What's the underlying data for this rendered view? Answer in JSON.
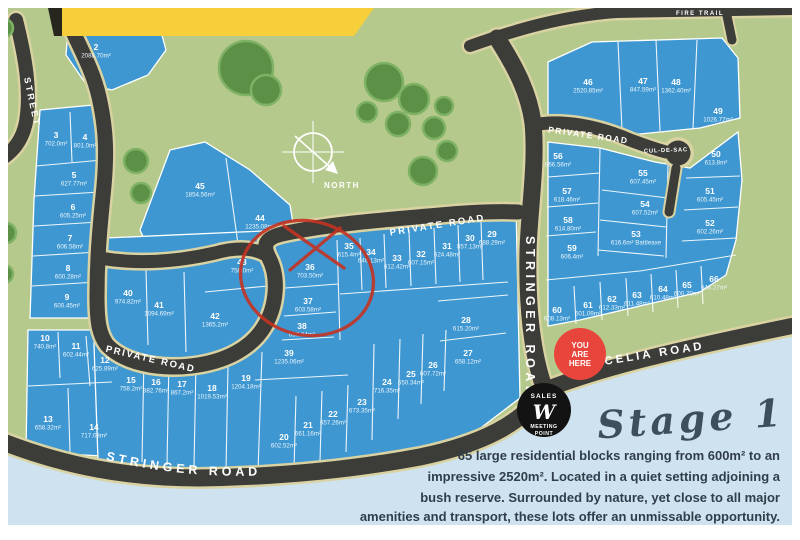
{
  "title": "Stage 1 estate map",
  "compass": {
    "label": "NORTH"
  },
  "roads": {
    "street_left": "STREET",
    "private_lower": "PRIVATE ROAD",
    "private_upper": "PRIVATE ROAD",
    "private_topright": "PRIVATE ROAD",
    "stringer_vertical": "STRINGER ROAD",
    "stringer_bottom": "STRINGER ROAD",
    "celia": "CELIA ROAD",
    "cul_de_sac": "CUL-DE-SAC",
    "fire_trail": "FIRE TRAIL"
  },
  "markers": {
    "you_are_here": {
      "lines": [
        "YOU",
        "ARE",
        "HERE"
      ],
      "color": "#e8463c"
    },
    "sales_point": {
      "top": "SALES",
      "logo": "W",
      "bottom1": "MEETING",
      "bottom2": "POINT",
      "color": "#131313"
    }
  },
  "stage": {
    "title": "Stage 1",
    "lines": [
      "65 large residential blocks ranging from 600m² to an",
      "impressive 2520m². Located in a quiet setting adjoining a",
      "bush reserve. Surrounded by nature, yet close to all major",
      "amenities and transport, these lots offer an unmissable opportunity."
    ]
  },
  "colors": {
    "green": "#b5c98c",
    "lot_blue": "#3e97d1",
    "pale_blue": "#cfe2ef",
    "road": "#3c3c38",
    "road_edge": "#d9d2a2",
    "tree": "#5d9047",
    "annotation_red": "#c53322",
    "banner_yellow": "#f6cf3b",
    "text_dark": "#2f3e4a"
  },
  "lots": [
    {
      "n": "2",
      "a": "2088.70m²",
      "x": 96,
      "y": 50
    },
    {
      "n": "3",
      "a": "702.0m²",
      "x": 56,
      "y": 138
    },
    {
      "n": "4",
      "a": "801.0m²",
      "x": 85,
      "y": 140
    },
    {
      "n": "5",
      "a": "627.77m²",
      "x": 74,
      "y": 178
    },
    {
      "n": "6",
      "a": "605.25m²",
      "x": 73,
      "y": 210
    },
    {
      "n": "7",
      "a": "606.58m²",
      "x": 70,
      "y": 241
    },
    {
      "n": "8",
      "a": "600.28m²",
      "x": 68,
      "y": 271
    },
    {
      "n": "9",
      "a": "600.45m²",
      "x": 67,
      "y": 300
    },
    {
      "n": "10",
      "a": "740.8m²",
      "x": 45,
      "y": 341
    },
    {
      "n": "11",
      "a": "602.44m²",
      "x": 76,
      "y": 349
    },
    {
      "n": "12",
      "a": "625.89m²",
      "x": 105,
      "y": 363
    },
    {
      "n": "13",
      "a": "658.32m²",
      "x": 48,
      "y": 422
    },
    {
      "n": "14",
      "a": "717.03m²",
      "x": 94,
      "y": 430
    },
    {
      "n": "15",
      "a": "758.2m²",
      "x": 131,
      "y": 383
    },
    {
      "n": "16",
      "a": "882.76m²",
      "x": 156,
      "y": 385
    },
    {
      "n": "17",
      "a": "867.2m²",
      "x": 182,
      "y": 387
    },
    {
      "n": "18",
      "a": "1019.53m²",
      "x": 212,
      "y": 391
    },
    {
      "n": "19",
      "a": "1204.18m²",
      "x": 246,
      "y": 381
    },
    {
      "n": "20",
      "a": "602.52m²",
      "x": 284,
      "y": 440
    },
    {
      "n": "21",
      "a": "661.16m²",
      "x": 308,
      "y": 428
    },
    {
      "n": "22",
      "a": "657.26m²",
      "x": 333,
      "y": 417
    },
    {
      "n": "23",
      "a": "673.35m²",
      "x": 362,
      "y": 405
    },
    {
      "n": "24",
      "a": "716.35m²",
      "x": 387,
      "y": 385
    },
    {
      "n": "25",
      "a": "650.34m²",
      "x": 411,
      "y": 377
    },
    {
      "n": "26",
      "a": "607.72m²",
      "x": 433,
      "y": 368
    },
    {
      "n": "27",
      "a": "658.12m²",
      "x": 468,
      "y": 356
    },
    {
      "n": "28",
      "a": "615.20m²",
      "x": 466,
      "y": 323
    },
    {
      "n": "29",
      "a": "688.29m²",
      "x": 492,
      "y": 237
    },
    {
      "n": "30",
      "a": "857.13m²",
      "x": 470,
      "y": 241
    },
    {
      "n": "31",
      "a": "624.48m²",
      "x": 447,
      "y": 249
    },
    {
      "n": "32",
      "a": "607.15m²",
      "x": 421,
      "y": 257
    },
    {
      "n": "33",
      "a": "612.42m²",
      "x": 397,
      "y": 261
    },
    {
      "n": "34",
      "a": "646.13m²",
      "x": 371,
      "y": 255
    },
    {
      "n": "35",
      "a": "615.4m²",
      "x": 349,
      "y": 249
    },
    {
      "n": "36",
      "a": "703.50m²",
      "x": 310,
      "y": 270
    },
    {
      "n": "37",
      "a": "603.58m²",
      "x": 308,
      "y": 304
    },
    {
      "n": "38",
      "a": "630.84m²",
      "x": 302,
      "y": 329
    },
    {
      "n": "39",
      "a": "1235.06m²",
      "x": 289,
      "y": 356
    },
    {
      "n": "40",
      "a": "974.82m²",
      "x": 128,
      "y": 296
    },
    {
      "n": "41",
      "a": "1094.69m²",
      "x": 159,
      "y": 308
    },
    {
      "n": "42",
      "a": "1365.2m²",
      "x": 215,
      "y": 319
    },
    {
      "n": "43",
      "a": "758.0m²",
      "x": 242,
      "y": 265
    },
    {
      "n": "44",
      "a": "1235.08m²",
      "x": 260,
      "y": 221
    },
    {
      "n": "45",
      "a": "1854.56m²",
      "x": 200,
      "y": 189
    },
    {
      "n": "46",
      "a": "2520.85m²",
      "x": 588,
      "y": 85
    },
    {
      "n": "47",
      "a": "847.59m²",
      "x": 643,
      "y": 84
    },
    {
      "n": "48",
      "a": "1362.40m²",
      "x": 676,
      "y": 85
    },
    {
      "n": "49",
      "a": "1026.77m²",
      "x": 718,
      "y": 114
    },
    {
      "n": "50",
      "a": "613.8m²",
      "x": 716,
      "y": 157
    },
    {
      "n": "51",
      "a": "605.45m²",
      "x": 710,
      "y": 194
    },
    {
      "n": "52",
      "a": "602.26m²",
      "x": 710,
      "y": 226
    },
    {
      "n": "53",
      "a": "616.6m² Battleaxe",
      "x": 636,
      "y": 237
    },
    {
      "n": "54",
      "a": "607.52m²",
      "x": 645,
      "y": 207
    },
    {
      "n": "55",
      "a": "607.45m²",
      "x": 643,
      "y": 176
    },
    {
      "n": "56",
      "a": "866.56m²",
      "x": 558,
      "y": 159
    },
    {
      "n": "57",
      "a": "618.46m²",
      "x": 567,
      "y": 194
    },
    {
      "n": "58",
      "a": "614.80m²",
      "x": 568,
      "y": 223
    },
    {
      "n": "59",
      "a": "606.4m²",
      "x": 572,
      "y": 251
    },
    {
      "n": "60",
      "a": "608.13m²",
      "x": 557,
      "y": 313
    },
    {
      "n": "61",
      "a": "601.09m²",
      "x": 588,
      "y": 308
    },
    {
      "n": "62",
      "a": "612.33m²",
      "x": 612,
      "y": 302
    },
    {
      "n": "63",
      "a": "611.48m²",
      "x": 637,
      "y": 298
    },
    {
      "n": "64",
      "a": "610.48m²",
      "x": 663,
      "y": 292
    },
    {
      "n": "65",
      "a": "600.70m²",
      "x": 687,
      "y": 288
    },
    {
      "n": "66",
      "a": "646.27m²",
      "x": 714,
      "y": 282
    }
  ]
}
